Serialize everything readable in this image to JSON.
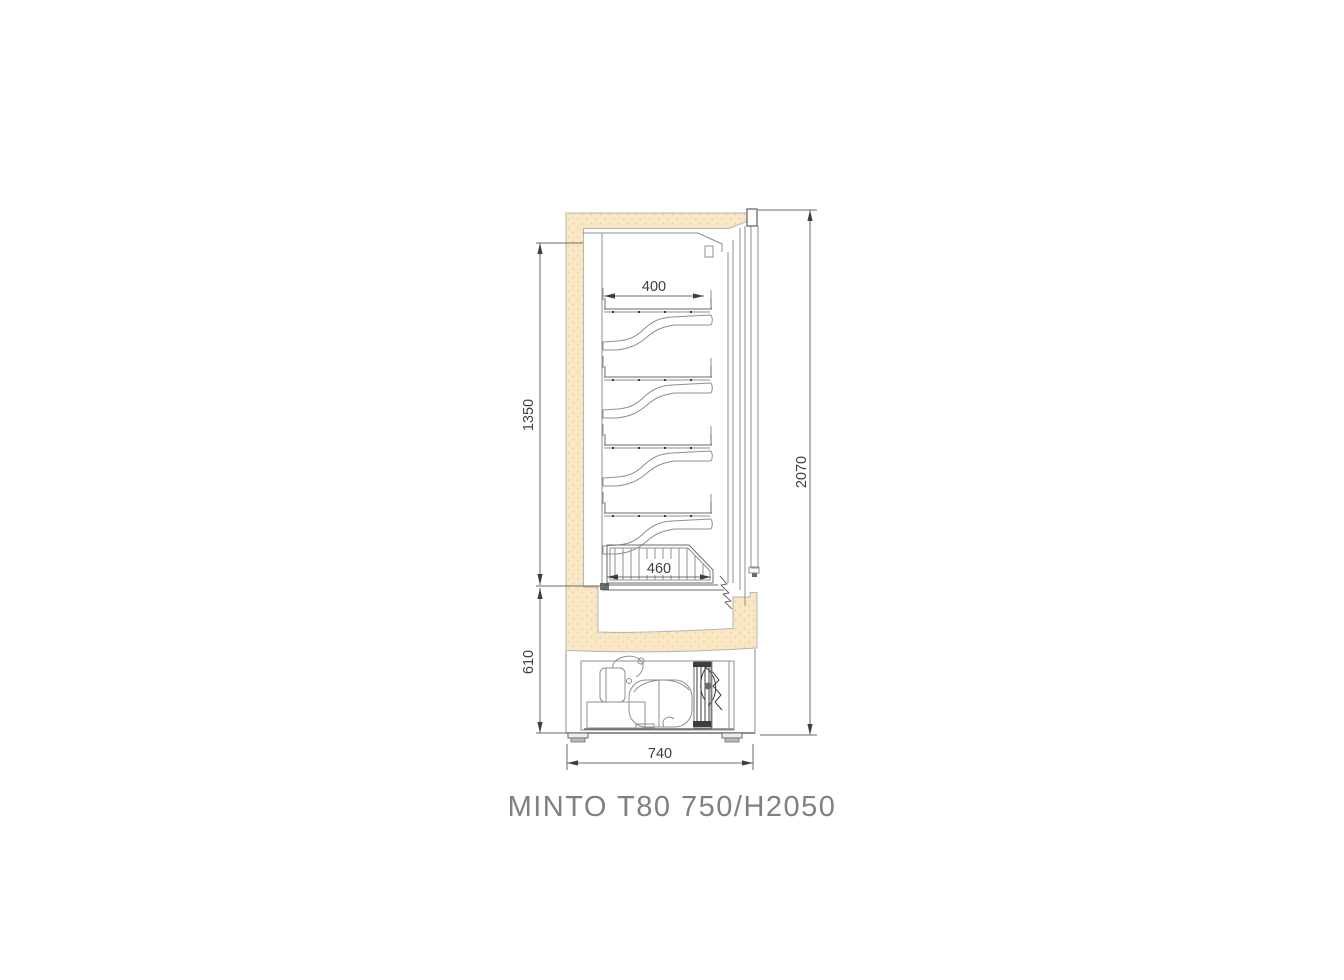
{
  "title": "MINTO T80 750/H2050",
  "dimensions": {
    "shelf_width": "400",
    "display_height": "1350",
    "machine_height": "610",
    "total_height": "2070",
    "basket_width": "460",
    "depth": "740"
  },
  "colors": {
    "insulation": "#F9E7C3",
    "insulation_dot": "#E0C894",
    "line": "#8F8F8F",
    "mid": "#6B6B6B",
    "dark": "#3E3E3E",
    "edge": "#B5B5B5",
    "title": "#7E8184"
  }
}
